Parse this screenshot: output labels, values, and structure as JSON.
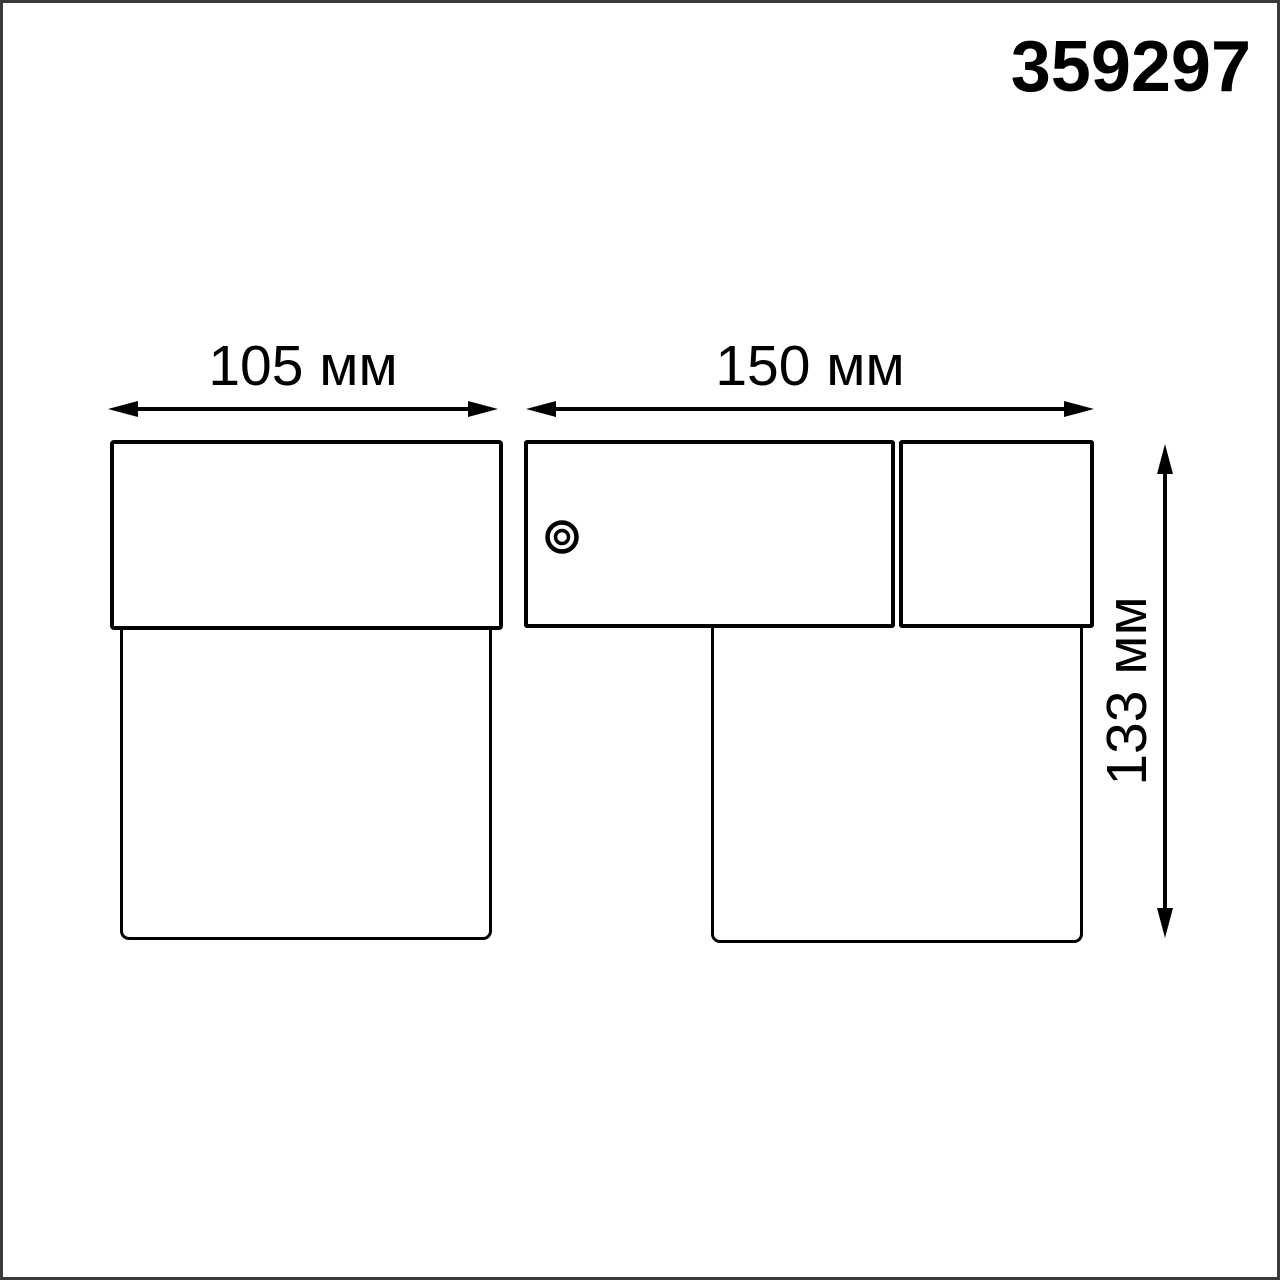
{
  "header": {
    "product_code": "359297"
  },
  "diagram": {
    "labels": {
      "width_left": "105 мм",
      "width_right": "150 мм",
      "height": "133 мм"
    },
    "values_mm": {
      "width_left": 105,
      "width_right": 150,
      "height": 133
    },
    "icons": {
      "screw": "screw-head-icon"
    },
    "colors": {
      "line": "#000000",
      "text": "#000000",
      "frame": "#3a3a3a",
      "background": "#ffffff"
    }
  }
}
